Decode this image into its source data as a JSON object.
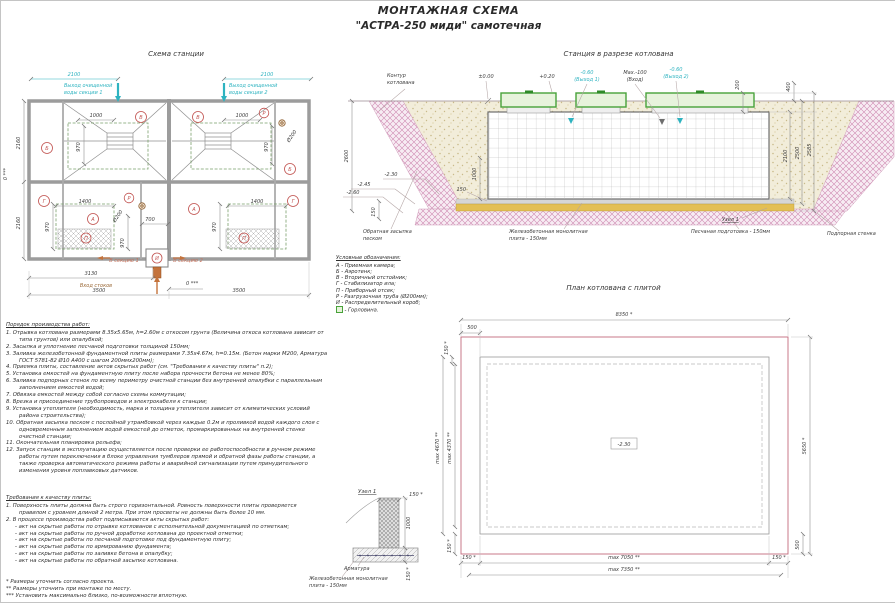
{
  "sheet": {
    "title": "МОНТАЖНАЯ СХЕМА",
    "subtitle": "\"АСТРА-250 миди\" самотечная"
  },
  "station_plan": {
    "title": "Схема станции",
    "outlet1_l1": "Выход очищенной",
    "outlet1_l2": "воды секции 1",
    "outlet2_l1": "Выход очищенной",
    "outlet2_l2": "воды секции 2",
    "to_section1": "В секцию 1",
    "to_section2": "В секцию 2",
    "inlet": "Вход стоков",
    "dims": {
      "w2100": "2100",
      "w1000": "1000",
      "h970": "970",
      "h2160": "2160",
      "w1400": "1400",
      "w700": "700",
      "w3130": "3130",
      "w3500": "3500",
      "zero": "0 ***",
      "pipe": "Ø200"
    },
    "tags": {
      "a": "А",
      "b": "Б",
      "v": "В",
      "g": "Г",
      "p": "П",
      "r": "Р",
      "i": "И"
    }
  },
  "cross_section": {
    "title": "Станция в разрезе котлована",
    "pit_contour_l1": "Контур",
    "pit_contour_l2": "котлована",
    "lvl_zero": "±0.00",
    "lvl_020": "+0.20",
    "outlet1_l1": "-0.60",
    "outlet1_l2": "(Выход 1)",
    "inlet_l1": "Max.-100",
    "inlet_l2": "(Вход)",
    "outlet2_l1": "-0.60",
    "outlet2_l2": "(Выход 2)",
    "lvl_230": "-2.30",
    "lvl_245": "-2.45",
    "lvl_260": "-2.60",
    "dims": {
      "d200": "200",
      "d400": "400",
      "d2100": "2100",
      "d2500": "2500",
      "d2585": "2585",
      "d2600": "2600",
      "d150": "150",
      "d1000": "1000"
    },
    "backfill_l1": "Обратная засыпка",
    "backfill_l2": "песком",
    "plate_l1": "Железобетонная монолитная",
    "plate_l2": "плита - 150мм",
    "sand_prep": "Песчаная подготовка - 150мм",
    "node_ref": "Узел 1",
    "retaining_wall": "Подпорная стенка"
  },
  "legend": {
    "title": "Условные обозначения:",
    "items": [
      "А - Приемная камера;",
      "Б - Аэротенк;",
      "В - Вторичный отстойник;",
      "Г - Стабилизатор ила;",
      "П - Приборный отсек;",
      "Р - Разгрузочная труба (Ø200мм);",
      "И - Распределительный короб;"
    ],
    "neck": "- Горловина."
  },
  "pit_plan": {
    "title": "План котлована с плитой",
    "lvl_230": "-2.30",
    "dims": {
      "d8350": "8350 *",
      "d500": "500",
      "d150": "150 *",
      "d4670": "max 4670 **",
      "d4370": "max 4370 **",
      "d5650": "5650 *",
      "d7050": "max 7050 **",
      "d7350": "max 7350 **"
    }
  },
  "node_detail": {
    "title": "Узел 1",
    "dims": {
      "d150": "150 *",
      "d1000": "1000"
    },
    "rebar": "Арматура",
    "plate_l1": "Железобетонная монолитная",
    "plate_l2": "плита - 150мм"
  },
  "work_order": {
    "title": "Порядок производства работ:",
    "items": [
      "1.  Отрывка котлована размерами 8.35х5.65м, h=2.60м с откосом грунта (Величина откоса котлована зависит от типа грунтов) или опалубкой;",
      "2.  Засыпка и уплотнение песчаной подготовки толщиной 150мм;",
      "3.  Заливка железобетонной фундаментной плиты размерами 7.35х4.67м, h=0.15м. (Бетон марки М200, Арматура ГОСТ 5781-82 Ø10 А400 с шагом 200ммх200мм);",
      "4.  Приемка плиты, составление актов скрытых работ (см. \"Требования к качеству плиты\" п.2);",
      "5.  Установка емкостей на фундаментную плиту после набора прочности бетона не менее 80%;",
      "6.  Заливка подпорных стенок по всему периметру очистной станции без внутренней опалубки с параллельным заполнением емкостей водой;",
      "7.  Обвязка емкостей между собой согласно схемы коммутации;",
      "8.  Врезка и присоединение трубопроводов и электрокабеля к станции;",
      "9.  Установка утеплителя (необходимость, марка и толщина утеплителя зависит от климатических условий района строительства);",
      "10. Обратная засыпка песком с послойной утрамбовкой через каждые 0.2м и проливкой водой каждого слоя с одновременным заполнением водой емкостей до отметок, промаркированных на внутренней стенке очистной станции;",
      "11. Окончательная планировка рельефа;",
      "12. Запуск станции в эксплуатацию осуществляется после проверки ее работоспособности в ручном режиме работы путем переключения в блоке управления тумблеров прямой и обратной фазы работы станции, а также проверка автоматического режима работы и аварийной сигнализации путем принудительного изменения уровня поплавковых датчиков."
    ]
  },
  "quality": {
    "title": "Требования к качеству плиты:",
    "items": [
      "1.  Поверхность плиты должна быть строго горизонтальной. Ровность поверхности плиты проверяется правилом с уровнем длиной 2 метра. При этом просветы не должны быть более 10 мм.",
      "2.  В процессе производства работ подписываются акты скрытых работ:"
    ],
    "acts": [
      "- акт на скрытые работы по отрывке котлованов с исполнительной документацией по отметкам;",
      "- акт на скрытые работы по ручной доработке котлована до проектной отметки;",
      "- акт на скрытые работы по песчаной подготовке под фундаментную плиту;",
      "- акт на скрытые работы по армированию фундамента;",
      "- акт на скрытые работы по заливке бетона в опалубку;",
      "- акт на скрытые работы по обратной засыпке котлована."
    ]
  },
  "notes": [
    "* Размеры уточнить согласно проекта.",
    "** Размеры уточнить при монтаже по месту.",
    "*** Установить максимально близко, по-возможности вплотную."
  ]
}
